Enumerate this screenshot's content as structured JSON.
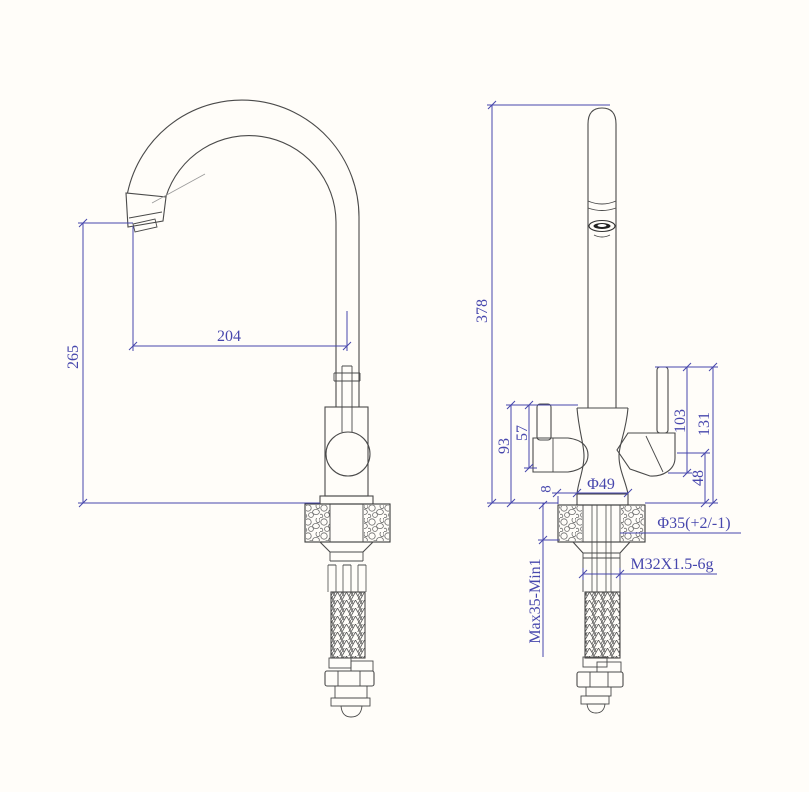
{
  "colors": {
    "dimension_text": "#4747ad",
    "line": "#3a3a3a",
    "background": "#fffdf9"
  },
  "side_view": {
    "reach": "204",
    "height_to_spout": "265"
  },
  "front_view": {
    "overall_height": "378",
    "body_top_height": "93",
    "handle_top_height": "57",
    "base_edge_offset": "8",
    "base_diameter": "Φ49",
    "right_handle_lever_height": "103",
    "right_handle_overall_height": "131",
    "right_handle_base_height": "48",
    "mounting_hole_diameter": "Φ35(+2/-1)",
    "thread_spec": "M32X1.5-6g",
    "mounting_thickness": "Max35-Min1"
  }
}
